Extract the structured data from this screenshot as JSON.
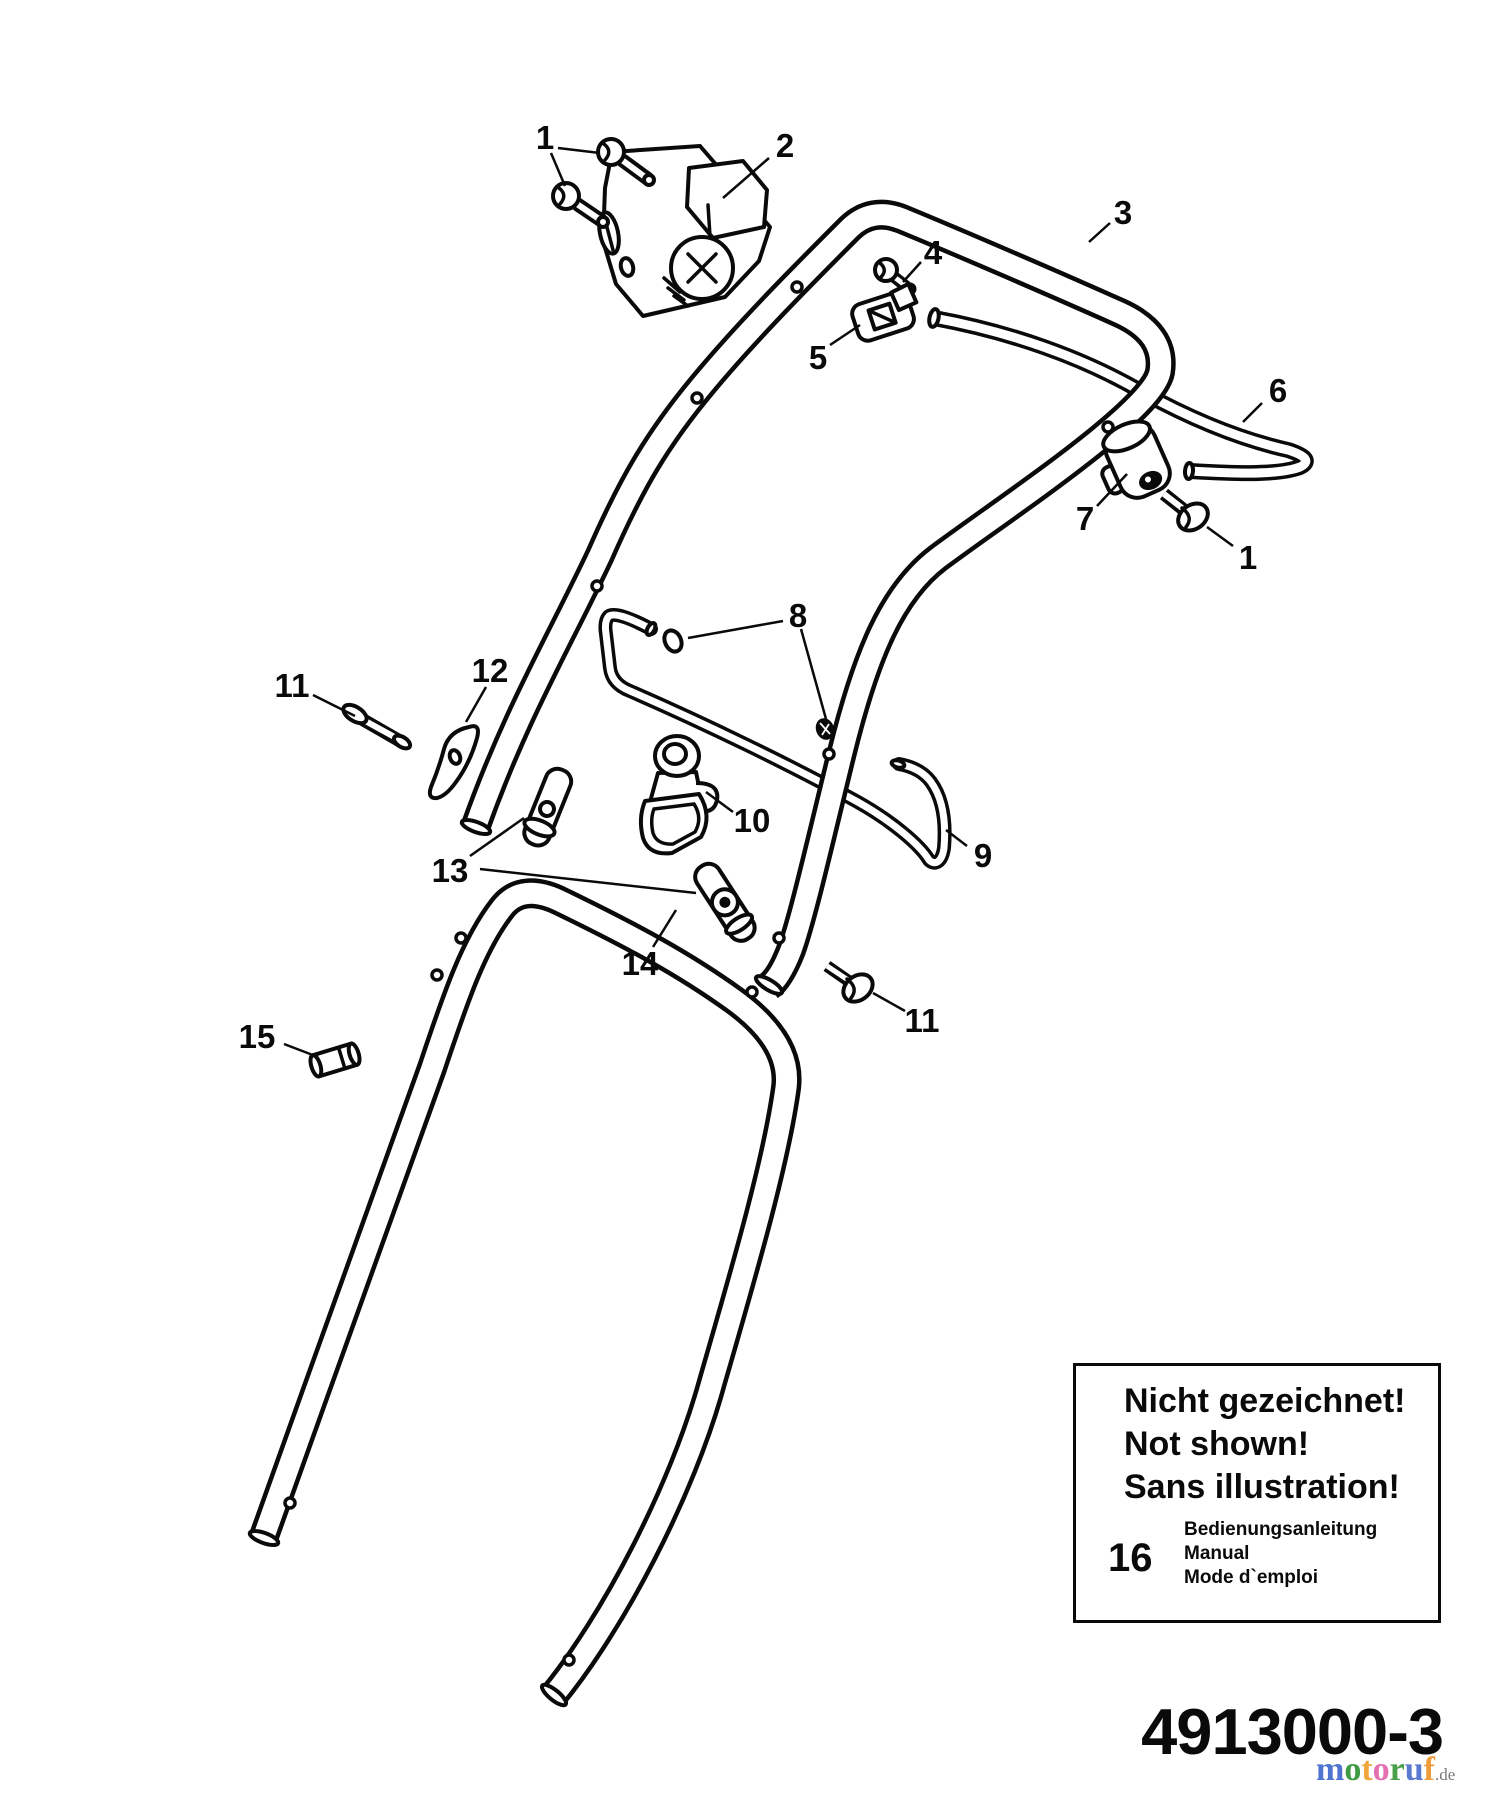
{
  "page": {
    "background": "#ffffff",
    "ink": "#0a0a0a"
  },
  "diagram": {
    "callouts": [
      {
        "id": "1-top",
        "label": "1",
        "x": 545,
        "y": 137,
        "leaders": [
          [
            558,
            148,
            600,
            153
          ],
          [
            551,
            153,
            565,
            186
          ]
        ]
      },
      {
        "id": "2",
        "label": "2",
        "x": 785,
        "y": 145,
        "leaders": [
          [
            769,
            158,
            723,
            198
          ]
        ]
      },
      {
        "id": "3",
        "label": "3",
        "x": 1123,
        "y": 212,
        "leaders": [
          [
            1110,
            223,
            1089,
            242
          ]
        ]
      },
      {
        "id": "4",
        "label": "4",
        "x": 933,
        "y": 252,
        "leaders": [
          [
            921,
            262,
            903,
            282
          ]
        ]
      },
      {
        "id": "5",
        "label": "5",
        "x": 818,
        "y": 357,
        "leaders": [
          [
            830,
            345,
            860,
            325
          ]
        ]
      },
      {
        "id": "6",
        "label": "6",
        "x": 1278,
        "y": 390,
        "leaders": [
          [
            1262,
            403,
            1243,
            422
          ]
        ]
      },
      {
        "id": "7",
        "label": "7",
        "x": 1085,
        "y": 518,
        "leaders": [
          [
            1097,
            506,
            1127,
            474
          ]
        ]
      },
      {
        "id": "1-right",
        "label": "1",
        "x": 1248,
        "y": 557,
        "leaders": [
          [
            1233,
            546,
            1207,
            527
          ]
        ]
      },
      {
        "id": "8",
        "label": "8",
        "x": 798,
        "y": 615,
        "leaders": [
          [
            783,
            621,
            688,
            638
          ],
          [
            801,
            629,
            826,
            719
          ]
        ]
      },
      {
        "id": "12",
        "label": "12",
        "x": 490,
        "y": 670,
        "leaders": [
          [
            486,
            687,
            466,
            722
          ]
        ]
      },
      {
        "id": "11-left",
        "label": "11",
        "x": 292,
        "y": 685,
        "leaders": [
          [
            313,
            695,
            355,
            716
          ]
        ]
      },
      {
        "id": "10",
        "label": "10",
        "x": 752,
        "y": 820,
        "leaders": [
          [
            733,
            812,
            706,
            792
          ]
        ]
      },
      {
        "id": "9",
        "label": "9",
        "x": 983,
        "y": 855,
        "leaders": [
          [
            967,
            846,
            946,
            830
          ]
        ]
      },
      {
        "id": "13",
        "label": "13",
        "x": 450,
        "y": 870,
        "leaders": [
          [
            470,
            856,
            524,
            818
          ],
          [
            480,
            869,
            696,
            893
          ]
        ]
      },
      {
        "id": "14",
        "label": "14",
        "x": 640,
        "y": 963,
        "leaders": [
          [
            653,
            947,
            676,
            910
          ]
        ]
      },
      {
        "id": "11-right",
        "label": "11",
        "x": 922,
        "y": 1020,
        "leaders": [
          [
            905,
            1011,
            873,
            993
          ]
        ]
      },
      {
        "id": "15",
        "label": "15",
        "x": 257,
        "y": 1036,
        "leaders": [
          [
            284,
            1044,
            318,
            1057
          ]
        ]
      }
    ],
    "notice_box": {
      "title_lines": [
        "Nicht gezeichnet!",
        "Not shown!",
        "Sans illustration!"
      ],
      "item_number": "16",
      "item_lines": [
        "Bedienungsanleitung",
        "Manual",
        "Mode d`emploi"
      ]
    }
  },
  "footer": {
    "part_number": "4913000-3"
  },
  "logo": {
    "word_letters": [
      {
        "ch": "m",
        "color": "#4f74cf"
      },
      {
        "ch": "o",
        "color": "#3f9a44"
      },
      {
        "ch": "t",
        "color": "#efa63b"
      },
      {
        "ch": "o",
        "color": "#e470b2"
      },
      {
        "ch": "r",
        "color": "#4aa04a"
      },
      {
        "ch": "u",
        "color": "#5a78d0"
      },
      {
        "ch": "f",
        "color": "#ee9d3c"
      }
    ],
    "suffix": ".de",
    "suffix_color": "#777777"
  }
}
